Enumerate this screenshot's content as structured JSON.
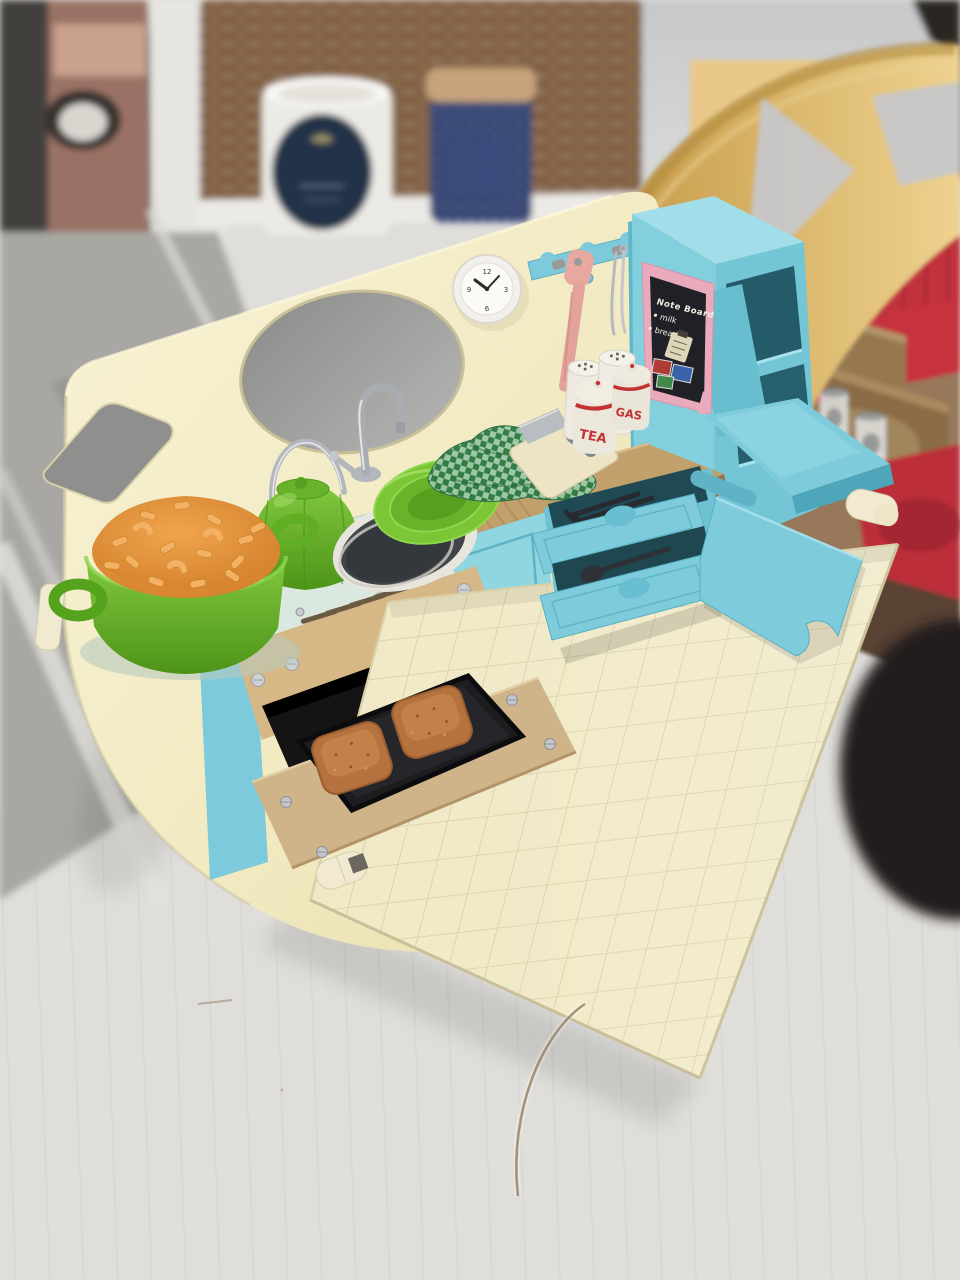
{
  "note_board": {
    "title": "Note Board",
    "items": [
      "milk",
      "bread"
    ]
  },
  "canisters": {
    "tea": "TEA",
    "gas": "GAS"
  },
  "clock": {
    "n12": "12",
    "n3": "3",
    "n6": "6",
    "n9": "9"
  },
  "colors": {
    "shell_cream": "#f2ecc4",
    "kitchen_teal": "#7ecbdb",
    "teal_dark": "#4fa8bc",
    "counter_tan": "#c2a06c",
    "floor_tile": "#f0e9c6",
    "pot_green": "#6fbe2e",
    "mac_orange": "#e0913a",
    "couch_red": "#c2323e",
    "noteboard_pink": "#e9aabc",
    "board_black": "#202126",
    "bread_brown": "#b5713e",
    "letter_red": "#c23434"
  }
}
